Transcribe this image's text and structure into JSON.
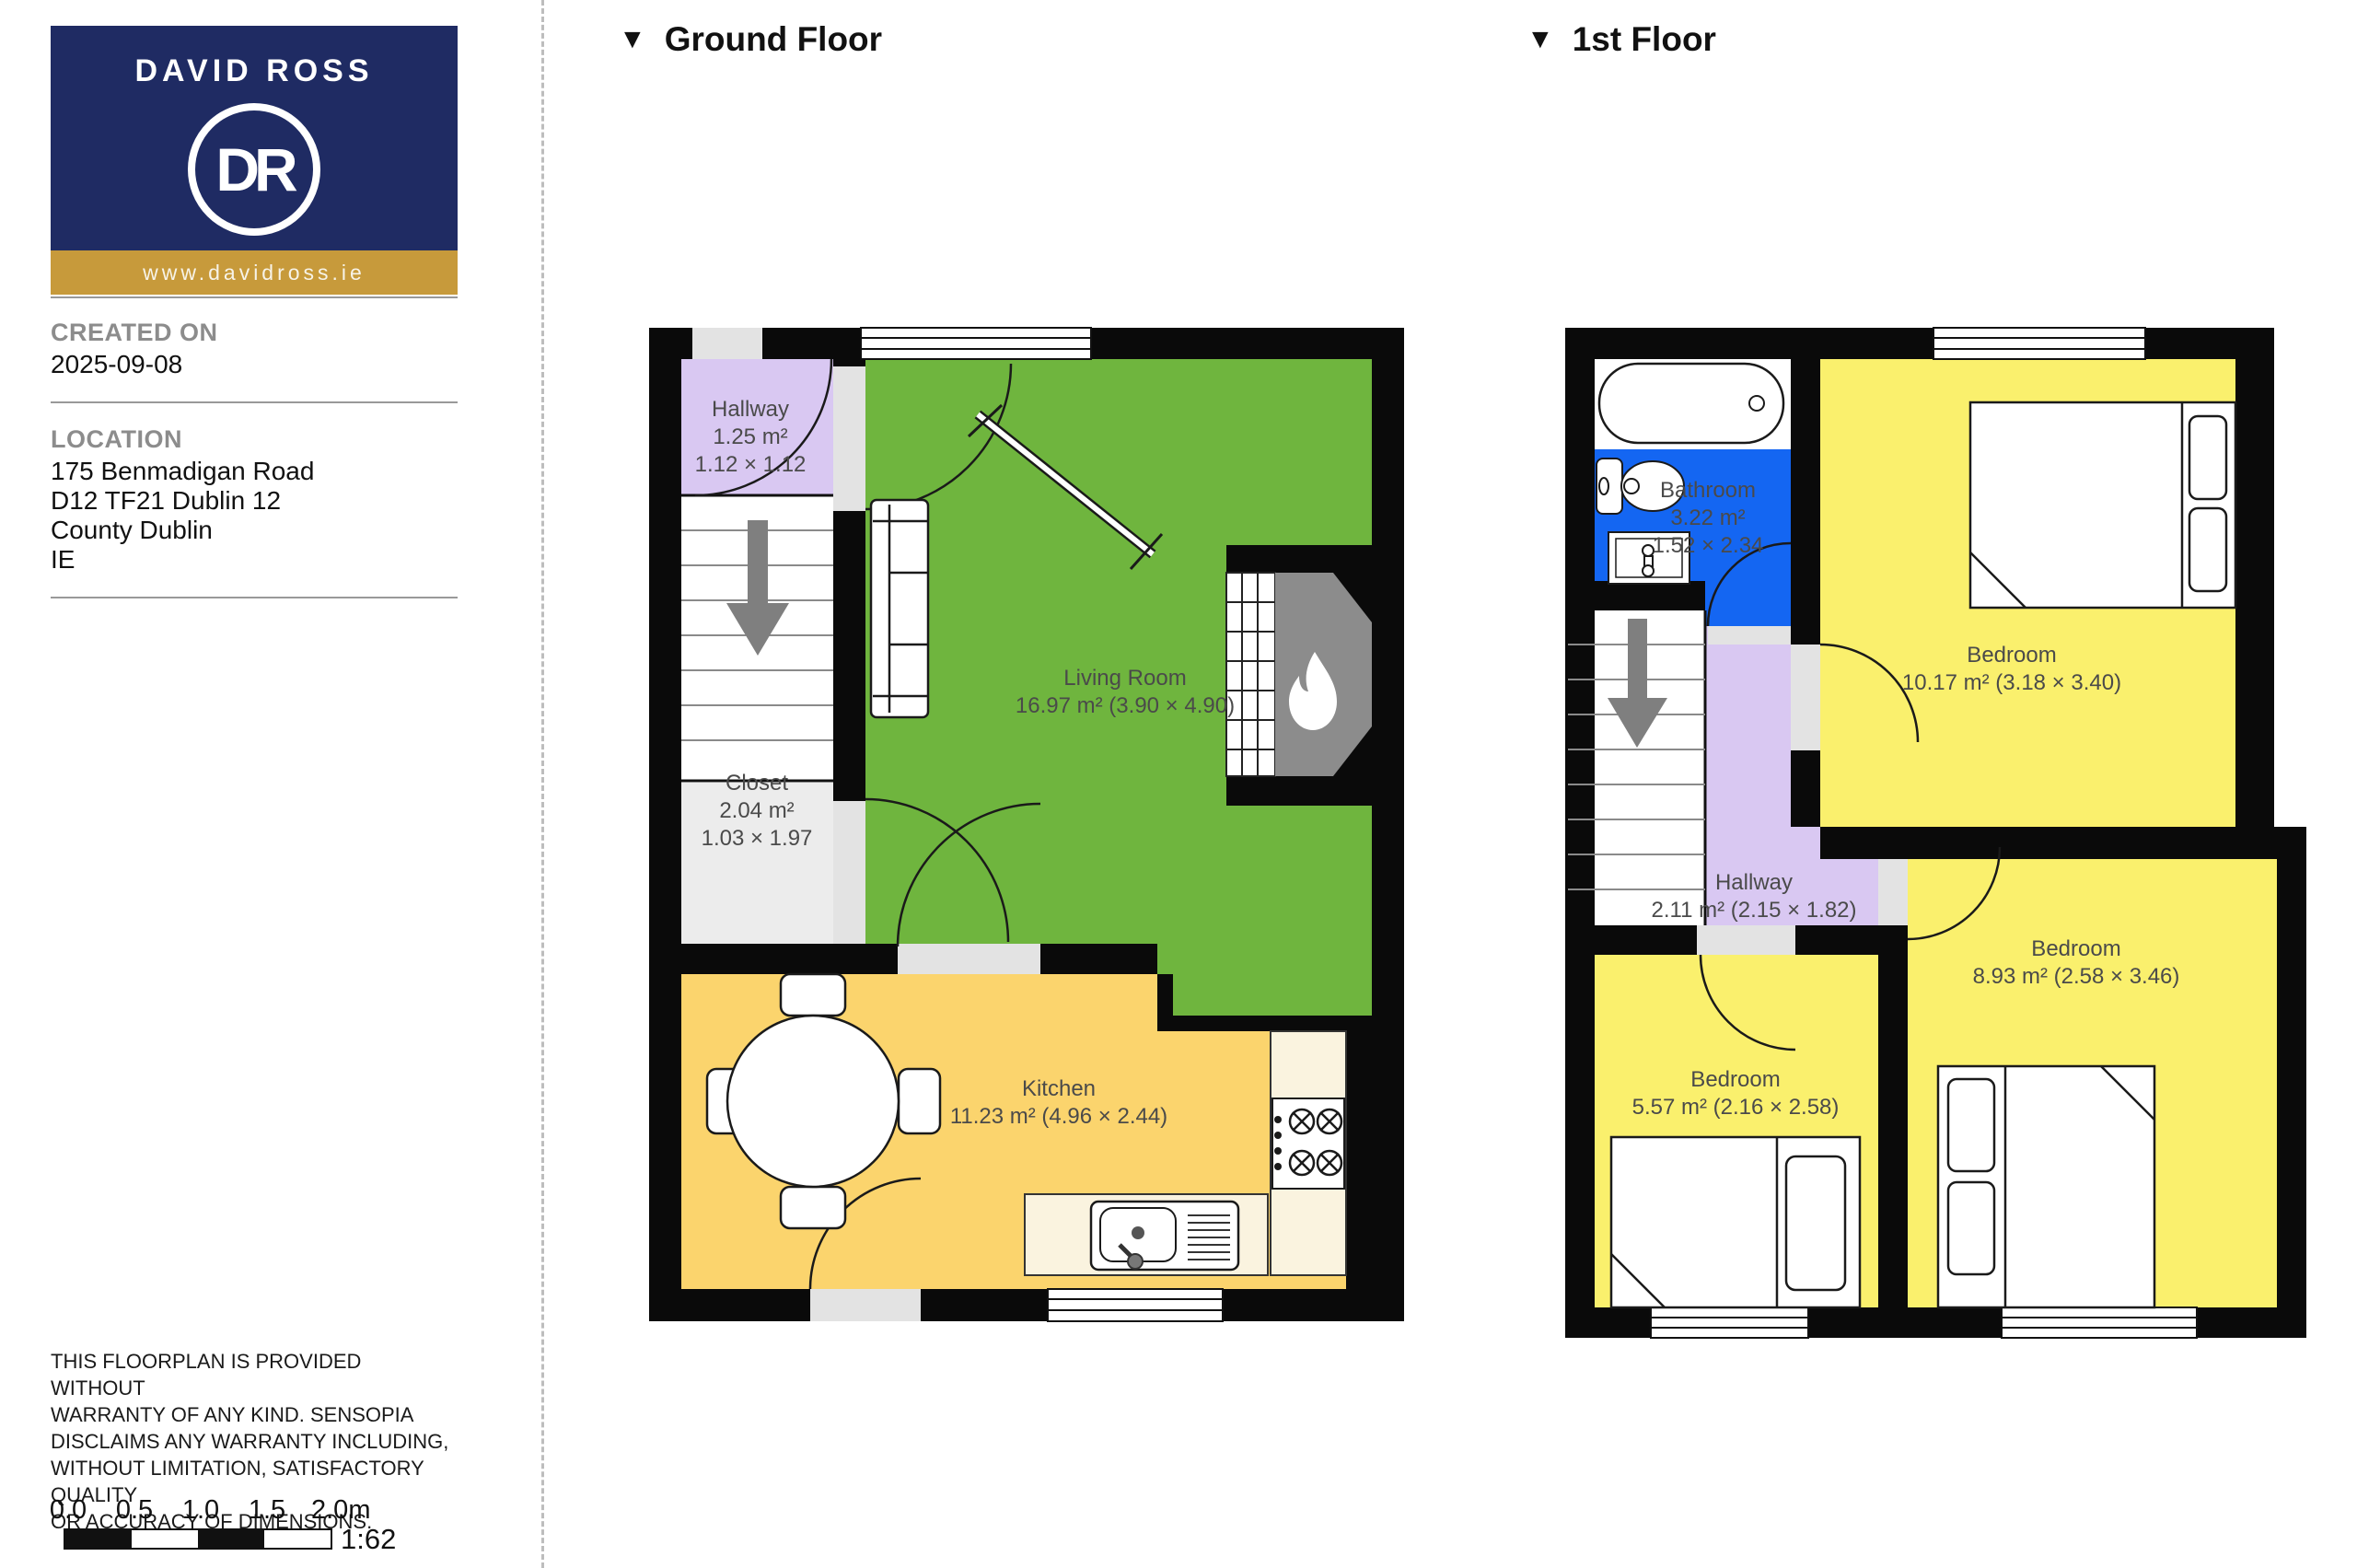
{
  "branding": {
    "name": "DAVID ROSS",
    "monogram": "DR",
    "website": "www.davidross.ie",
    "navy": "#1F2B63",
    "gold": "#C79A3B"
  },
  "meta": {
    "created_label": "CREATED ON",
    "created_date": "2025-09-08",
    "location_label": "LOCATION",
    "address_lines": [
      "175 Benmadigan Road",
      "D12 TF21 Dublin 12",
      "County Dublin",
      "IE"
    ]
  },
  "disclaimer_lines": [
    "THIS FLOORPLAN IS PROVIDED WITHOUT",
    "WARRANTY OF ANY KIND. SENSOPIA",
    "DISCLAIMS ANY WARRANTY INCLUDING,",
    "WITHOUT LIMITATION, SATISFACTORY QUALITY",
    "OR ACCURACY OF DIMENSIONS."
  ],
  "scale_bar": {
    "ticks": [
      "0.0",
      "0.5",
      "1.0",
      "1.5",
      "2.0m"
    ],
    "ratio": "1:62"
  },
  "floors": [
    {
      "title": "Ground Floor",
      "marker": "▼",
      "rooms": [
        {
          "id": "hallway",
          "lines": [
            "Hallway",
            "1.25 m²",
            "1.12 × 1.12"
          ]
        },
        {
          "id": "living-room",
          "lines": [
            "Living Room",
            "16.97 m² (3.90 × 4.90)"
          ]
        },
        {
          "id": "closet",
          "lines": [
            "Closet",
            "2.04 m²",
            "1.03 × 1.97"
          ]
        },
        {
          "id": "kitchen",
          "lines": [
            "Kitchen",
            "11.23 m² (4.96 × 2.44)"
          ]
        }
      ]
    },
    {
      "title": "1st Floor",
      "marker": "▼",
      "rooms": [
        {
          "id": "bathroom",
          "lines": [
            "Bathroom",
            "3.22 m²",
            "1.52 × 2.34"
          ]
        },
        {
          "id": "bedroom-1",
          "lines": [
            "Bedroom",
            "10.17 m² (3.18 × 3.40)"
          ]
        },
        {
          "id": "hallway",
          "lines": [
            "Hallway",
            "2.11 m² (2.15 × 1.82)"
          ]
        },
        {
          "id": "bedroom-2",
          "lines": [
            "Bedroom",
            "5.57 m² (2.16 × 2.58)"
          ]
        },
        {
          "id": "bedroom-3",
          "lines": [
            "Bedroom",
            "8.93 m² (2.58 × 3.46)"
          ]
        }
      ]
    }
  ],
  "colors": {
    "wall": "#0A0A0A",
    "living_green": "#6FB53E",
    "hallway_purple": "#D9C8F2",
    "closet_gray": "#ECECEC",
    "kitchen_orange": "#FBD46D",
    "bedroom_yellow": "#FAF06D",
    "bathroom_blue": "#1466F2",
    "counter_cream": "#FAF3DF",
    "chimney_gray": "#8C8C8C",
    "threshold_gray": "#E3E3E3"
  }
}
